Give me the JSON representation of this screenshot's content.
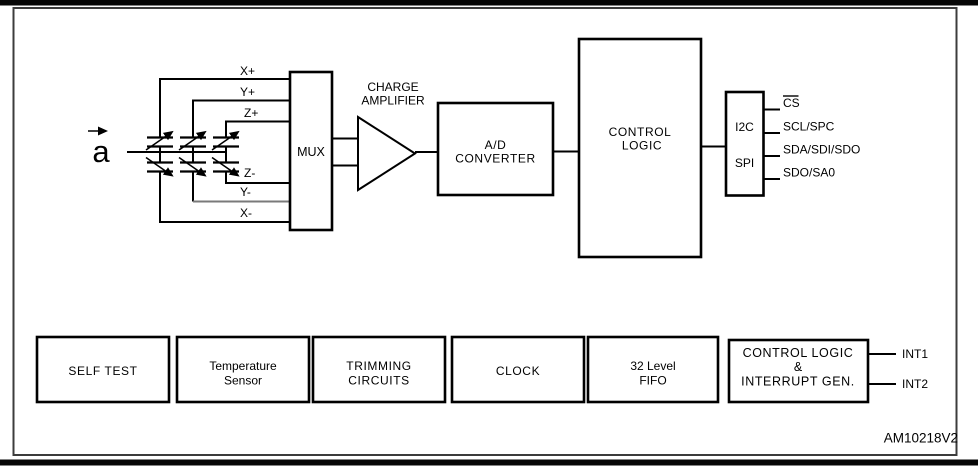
{
  "figure": {
    "id_label": "AM10218V2",
    "accel_input": {
      "symbol": "a"
    },
    "electrode_labels": {
      "x_plus": "X+",
      "y_plus": "Y+",
      "z_plus": "Z+",
      "z_minus": "Z-",
      "y_minus": "Y-",
      "x_minus": "X-"
    },
    "blocks": {
      "mux": {
        "label": "MUX"
      },
      "charge_amplifier": {
        "line1": "CHARGE",
        "line2": "AMPLIFIER"
      },
      "adc": {
        "line1": "A/D",
        "line2": "CONVERTER"
      },
      "control_logic": {
        "line1": "CONTROL",
        "line2": "LOGIC"
      },
      "serial_interface": {
        "line1": "I2C",
        "line2": "SPI"
      }
    },
    "interface_pins": [
      {
        "label": "CS",
        "active_low": true
      },
      {
        "label": "SCL/SPC",
        "active_low": false
      },
      {
        "label": "SDA/SDI/SDO",
        "active_low": false
      },
      {
        "label": "SDO/SA0",
        "active_low": false
      }
    ],
    "interrupt_pins": [
      {
        "label": "INT1"
      },
      {
        "label": "INT2"
      }
    ],
    "bottom_row": [
      {
        "line1": "SELF TEST",
        "line2": "",
        "line3": ""
      },
      {
        "line1": "Temperature",
        "line2": "Sensor",
        "line3": ""
      },
      {
        "line1": "TRIMMING",
        "line2": "CIRCUITS",
        "line3": ""
      },
      {
        "line1": "CLOCK",
        "line2": "",
        "line3": ""
      },
      {
        "line1": "32 Level",
        "line2": "FIFO",
        "line3": ""
      },
      {
        "line1": "CONTROL LOGIC",
        "line2": "&",
        "line3": "INTERRUPT GEN."
      }
    ],
    "colors": {
      "line": "#000000",
      "frame": "#3c3c3c",
      "dim_line": "#7a7a7a",
      "background": "#ffffff",
      "text": "#000000"
    }
  }
}
